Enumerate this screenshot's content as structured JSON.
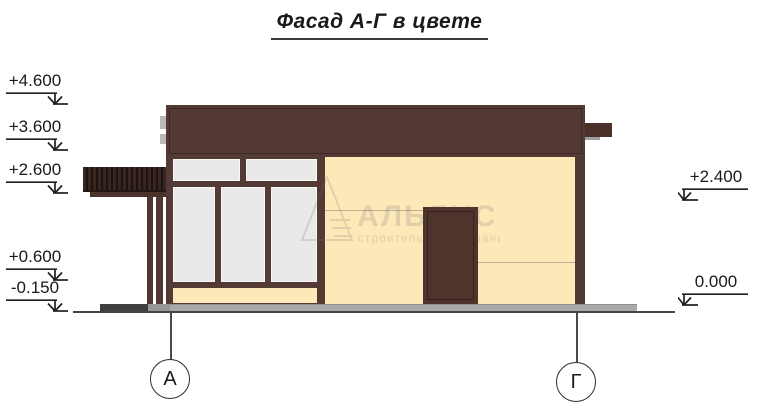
{
  "title": "Фасад А-Г в цвете",
  "watermark": {
    "name": "АЛЬЯНС",
    "subtitle": "строительная компания"
  },
  "elevations": {
    "left": [
      {
        "label": "+4.600"
      },
      {
        "label": "+3.600"
      },
      {
        "label": "+2.600"
      },
      {
        "label": "+0.600"
      },
      {
        "label": "-0.150"
      }
    ],
    "right": [
      {
        "label": "+2.400"
      },
      {
        "label": "0.000"
      }
    ]
  },
  "axes": {
    "left": "А",
    "right": "Г"
  },
  "colors": {
    "dark_brown": "#533a34",
    "door_brown": "#4d342c",
    "cream": "#fde9b8",
    "pane_gray": "#e9e9e9",
    "platform_gray": "#a8a8a8",
    "step_dark": "#3f3f3f"
  }
}
